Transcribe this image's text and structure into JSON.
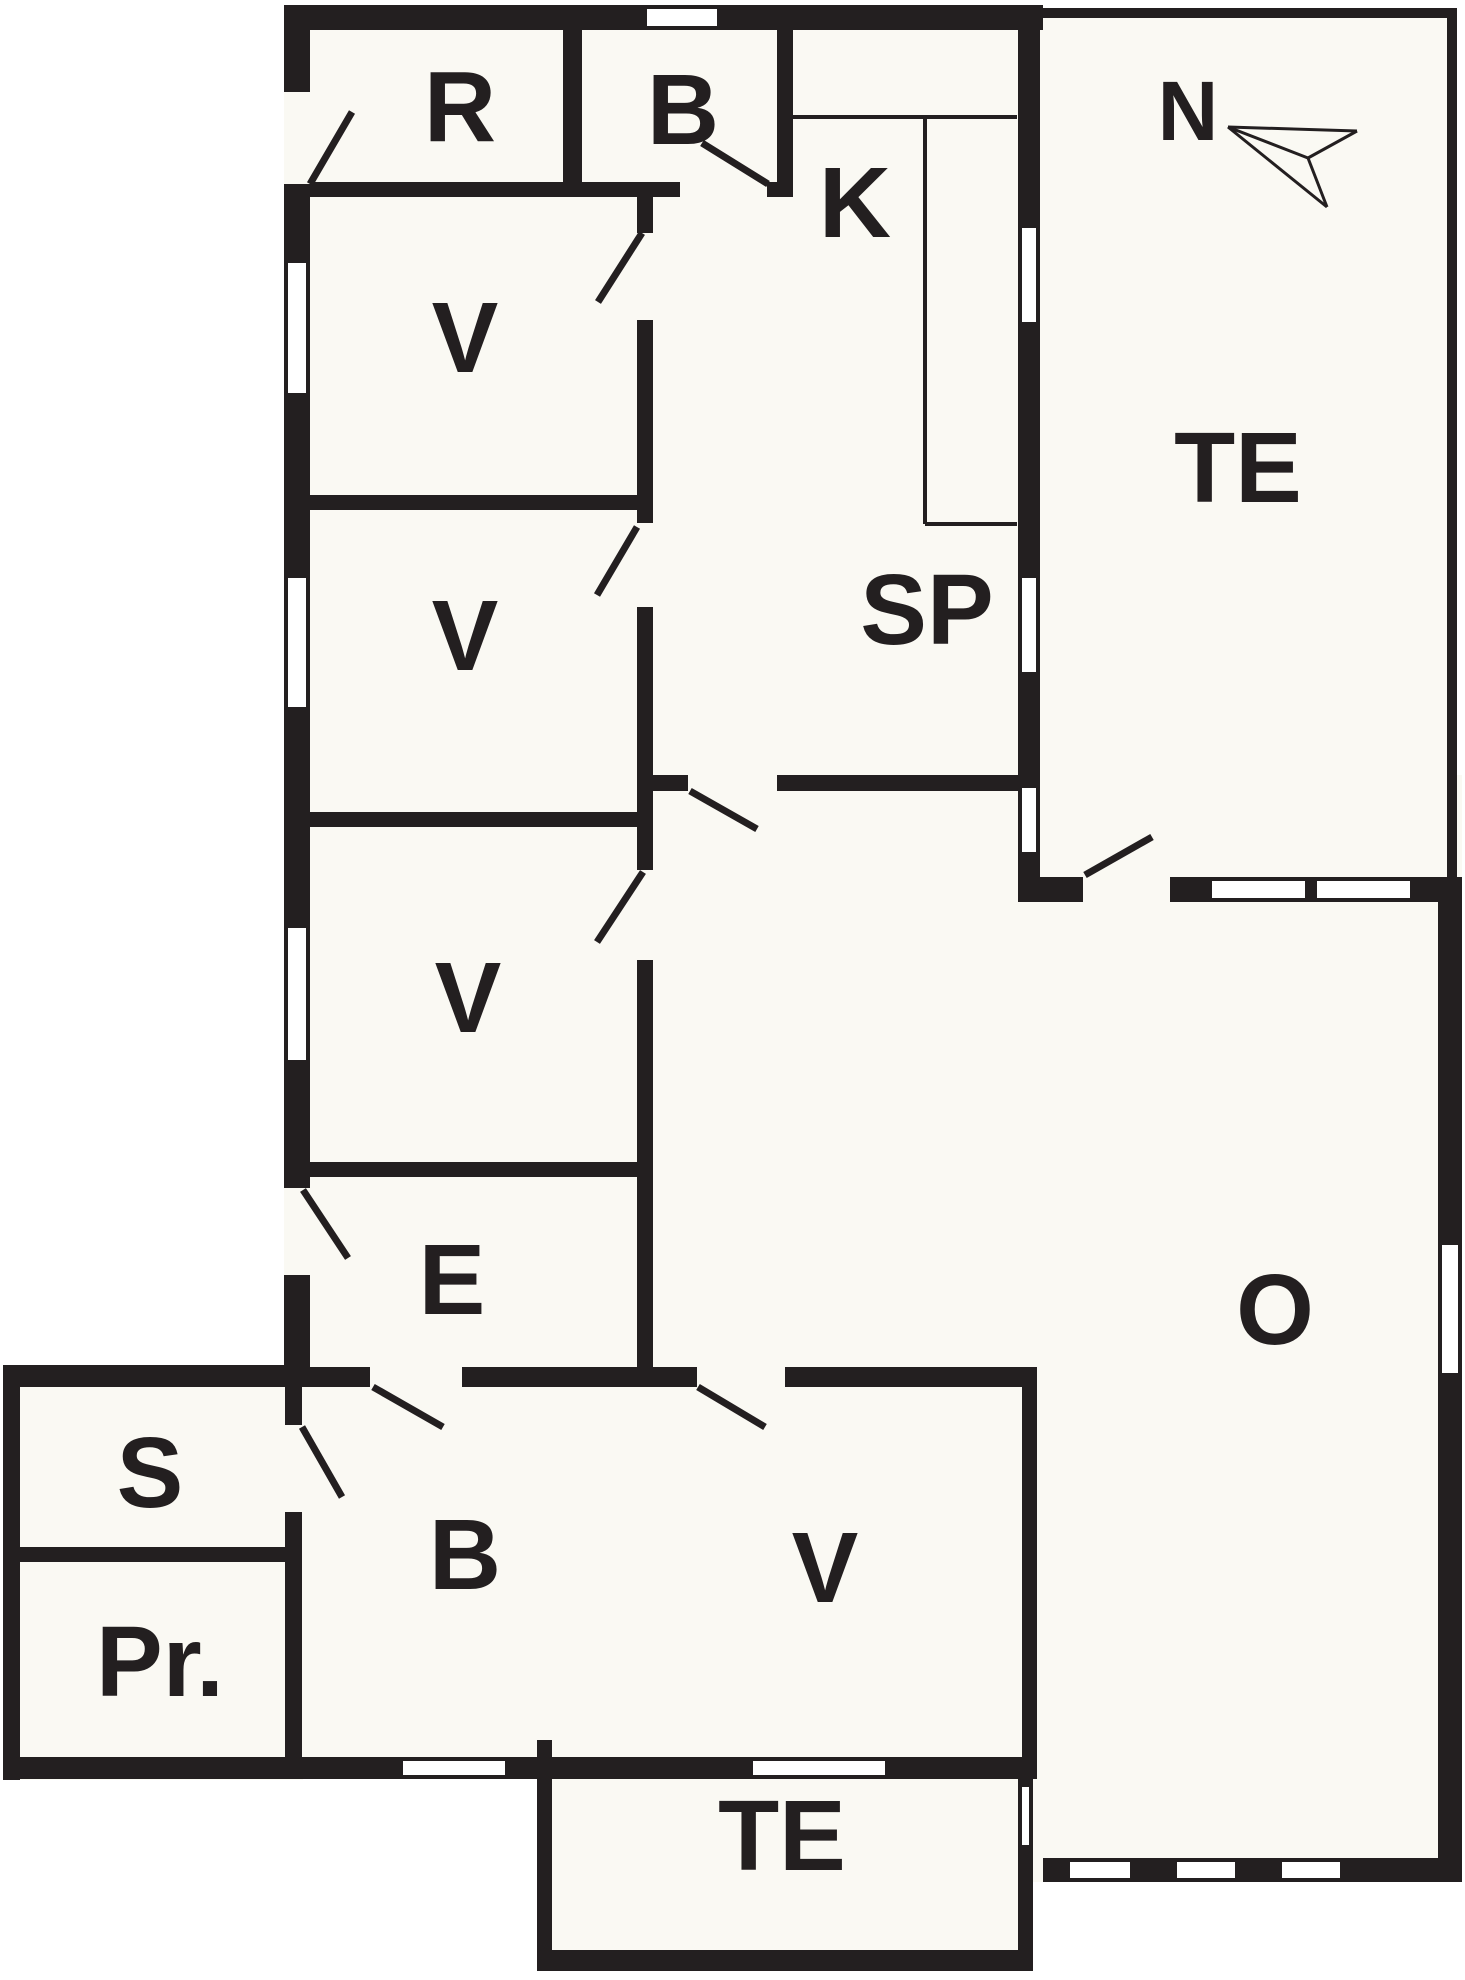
{
  "canvas": {
    "width": 1465,
    "height": 1980
  },
  "colors": {
    "outside": "#ffffff",
    "floor": "#faf9f3",
    "wall": "#231f20",
    "text": "#231f20"
  },
  "rooms": [
    {
      "id": "r",
      "label": "R",
      "x": 460,
      "y": 107,
      "size": 100
    },
    {
      "id": "b-top",
      "label": "B",
      "x": 683,
      "y": 110,
      "size": 100
    },
    {
      "id": "k",
      "label": "K",
      "x": 855,
      "y": 203,
      "size": 100
    },
    {
      "id": "v1",
      "label": "V",
      "x": 465,
      "y": 338,
      "size": 100
    },
    {
      "id": "v2",
      "label": "V",
      "x": 465,
      "y": 636,
      "size": 100
    },
    {
      "id": "v3",
      "label": "V",
      "x": 468,
      "y": 998,
      "size": 100
    },
    {
      "id": "sp",
      "label": "SP",
      "x": 927,
      "y": 610,
      "size": 100
    },
    {
      "id": "te-upper",
      "label": "TE",
      "x": 1238,
      "y": 468,
      "size": 100
    },
    {
      "id": "e",
      "label": "E",
      "x": 452,
      "y": 1280,
      "size": 100
    },
    {
      "id": "s",
      "label": "S",
      "x": 150,
      "y": 1473,
      "size": 100
    },
    {
      "id": "pr",
      "label": "Pr.",
      "x": 160,
      "y": 1662,
      "size": 100
    },
    {
      "id": "b-bottom",
      "label": "B",
      "x": 465,
      "y": 1555,
      "size": 100
    },
    {
      "id": "v4",
      "label": "V",
      "x": 825,
      "y": 1568,
      "size": 100
    },
    {
      "id": "o",
      "label": "O",
      "x": 1275,
      "y": 1310,
      "size": 100
    },
    {
      "id": "te-lower",
      "label": "TE",
      "x": 782,
      "y": 1836,
      "size": 100
    }
  ],
  "compass": {
    "label": "N",
    "x": 1188,
    "y": 111,
    "size": 84,
    "segments": [
      [
        1228,
        127,
        1357,
        131
      ],
      [
        1357,
        131,
        1308,
        158
      ],
      [
        1308,
        158,
        1228,
        127
      ],
      [
        1228,
        127,
        1327,
        207
      ],
      [
        1327,
        207,
        1308,
        158
      ]
    ]
  },
  "floors": [
    [
      284,
      5,
      759,
      1382
    ],
    [
      3,
      1365,
      300,
      415
    ],
    [
      284,
      1387,
      753,
      392
    ],
    [
      653,
      775,
      809,
      1107
    ],
    [
      1040,
      8,
      417,
      894
    ],
    [
      537,
      1740,
      496,
      231
    ]
  ],
  "walls": [
    [
      284,
      5,
      759,
      25
    ],
    [
      284,
      5,
      26,
      1382
    ],
    [
      3,
      1365,
      281,
      22
    ],
    [
      3,
      1365,
      17,
      415
    ],
    [
      3,
      1757,
      1034,
      22
    ],
    [
      20,
      1547,
      265,
      15
    ],
    [
      285,
      1387,
      17,
      370
    ],
    [
      563,
      5,
      19,
      192
    ],
    [
      777,
      5,
      16,
      192
    ],
    [
      284,
      182,
      396,
      15
    ],
    [
      767,
      182,
      26,
      15
    ],
    [
      637,
      197,
      16,
      1190
    ],
    [
      303,
      495,
      350,
      15
    ],
    [
      303,
      812,
      350,
      15
    ],
    [
      303,
      1162,
      350,
      15
    ],
    [
      303,
      1367,
      734,
      20
    ],
    [
      1022,
      1387,
      15,
      390
    ],
    [
      652,
      775,
      36,
      16
    ],
    [
      777,
      775,
      241,
      16
    ],
    [
      1018,
      18,
      22,
      884
    ],
    [
      1040,
      877,
      422,
      25
    ],
    [
      1438,
      902,
      24,
      980
    ],
    [
      1043,
      1858,
      419,
      24
    ],
    [
      537,
      1740,
      15,
      231
    ],
    [
      537,
      1950,
      496,
      21
    ],
    [
      1018,
      1775,
      15,
      196
    ]
  ],
  "thin_walls": [
    [
      1043,
      8,
      414,
      10
    ],
    [
      1447,
      8,
      10,
      894
    ]
  ],
  "door_openings": [
    [
      284,
      92,
      26,
      92
    ],
    [
      637,
      233,
      16,
      87
    ],
    [
      637,
      523,
      16,
      84
    ],
    [
      637,
      870,
      16,
      90
    ],
    [
      284,
      1188,
      26,
      87
    ],
    [
      285,
      1425,
      17,
      87
    ],
    [
      680,
      182,
      87,
      15
    ],
    [
      370,
      1367,
      92,
      20
    ],
    [
      697,
      1367,
      88,
      20
    ],
    [
      1083,
      877,
      87,
      25
    ]
  ],
  "windows": [
    {
      "x": 284,
      "y": 263,
      "w": 26,
      "h": 130,
      "o": "v"
    },
    {
      "x": 284,
      "y": 578,
      "w": 26,
      "h": 129,
      "o": "v"
    },
    {
      "x": 284,
      "y": 928,
      "w": 26,
      "h": 132,
      "o": "v"
    },
    {
      "x": 647,
      "y": 5,
      "w": 70,
      "h": 25,
      "o": "h"
    },
    {
      "x": 1018,
      "y": 228,
      "w": 22,
      "h": 94,
      "o": "v"
    },
    {
      "x": 1018,
      "y": 578,
      "w": 22,
      "h": 94,
      "o": "v"
    },
    {
      "x": 1018,
      "y": 788,
      "w": 22,
      "h": 64,
      "o": "v"
    },
    {
      "x": 1212,
      "y": 877,
      "w": 93,
      "h": 25,
      "o": "h"
    },
    {
      "x": 1317,
      "y": 877,
      "w": 93,
      "h": 25,
      "o": "h"
    },
    {
      "x": 1438,
      "y": 1245,
      "w": 24,
      "h": 128,
      "o": "v"
    },
    {
      "x": 1070,
      "y": 1858,
      "w": 60,
      "h": 24,
      "o": "h"
    },
    {
      "x": 1177,
      "y": 1858,
      "w": 58,
      "h": 24,
      "o": "h"
    },
    {
      "x": 1282,
      "y": 1858,
      "w": 58,
      "h": 24,
      "o": "h"
    },
    {
      "x": 403,
      "y": 1757,
      "w": 102,
      "h": 22,
      "o": "h"
    },
    {
      "x": 753,
      "y": 1757,
      "w": 132,
      "h": 22,
      "o": "h"
    },
    {
      "x": 1018,
      "y": 1787,
      "w": 15,
      "h": 58,
      "o": "v"
    }
  ],
  "door_leaves": [
    [
      310,
      184,
      352,
      112
    ],
    [
      642,
      233,
      598,
      302
    ],
    [
      637,
      527,
      597,
      595
    ],
    [
      643,
      872,
      597,
      942
    ],
    [
      303,
      1190,
      348,
      1258
    ],
    [
      302,
      1427,
      342,
      1497
    ],
    [
      702,
      143,
      768,
      184
    ],
    [
      373,
      1387,
      443,
      1427
    ],
    [
      698,
      1387,
      765,
      1427
    ],
    [
      690,
      791,
      757,
      829
    ],
    [
      1085,
      875,
      1152,
      837
    ]
  ],
  "counter_lines": [
    [
      793,
      117,
      1017,
      117
    ],
    [
      925,
      117,
      925,
      524
    ],
    [
      925,
      524,
      1017,
      524
    ]
  ],
  "stroke": {
    "leaf": 7,
    "thin": 4,
    "window_edge": 4
  }
}
